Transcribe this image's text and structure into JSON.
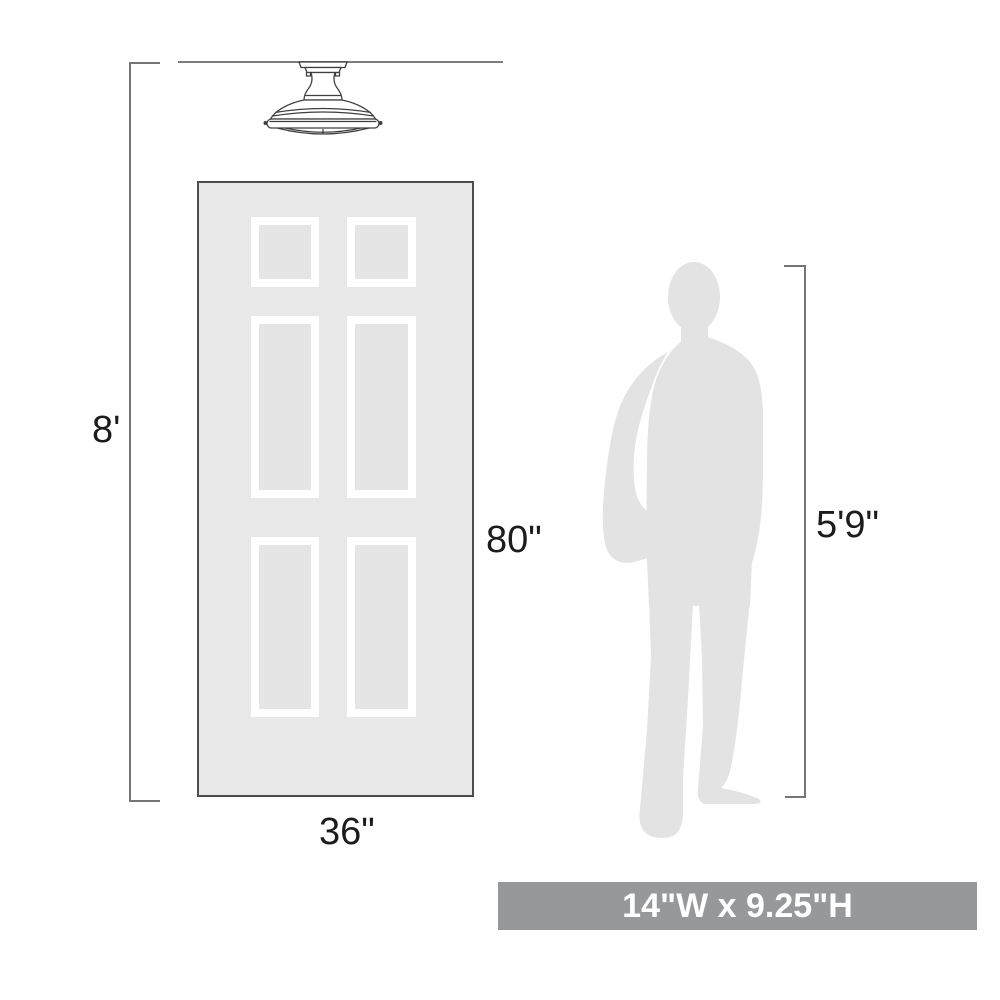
{
  "labels": {
    "ceiling_height": "8'",
    "door_height": "80\"",
    "door_width": "36\"",
    "person_height": "5'9\"",
    "product_size": "14\"W x 9.25\"H"
  },
  "colors": {
    "background": "#ffffff",
    "door_fill": "#e8e8e8",
    "door_border": "#4d4d4d",
    "panel_frame": "#ffffff",
    "panel_inner": "#e5e5e5",
    "person_fill": "#e3e3e3",
    "dimension_line": "#757575",
    "ceiling_line": "#7d7d7d",
    "fixture_stroke": "#3f3f3f",
    "banner_bg": "#97989a",
    "banner_text": "#ffffff",
    "label_text": "#1c1c1c"
  },
  "icons": {
    "fixture": "semi-flush-ceiling-light-icon",
    "door": "six-panel-door",
    "person": "standing-man-silhouette-icon"
  }
}
